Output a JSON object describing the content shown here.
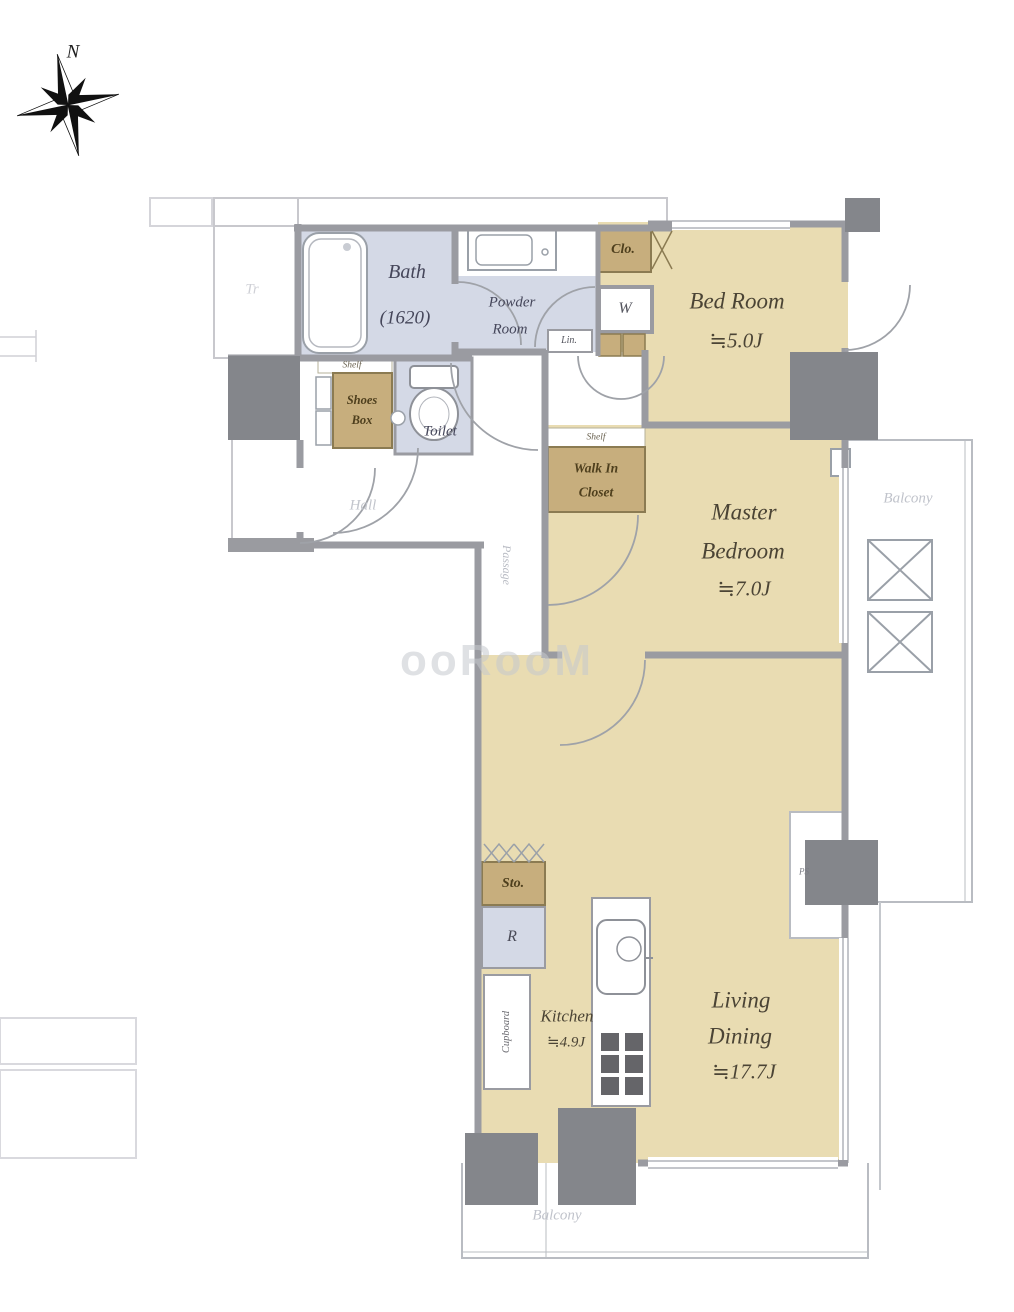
{
  "palette": {
    "room_tan": "#e9dcb2",
    "wet_blue": "#d4d9e6",
    "storage_brown": "#c7ae7d",
    "wall_gray": "#9a9ba1",
    "column_gray": "#84868b",
    "label_brown": "#4b4435",
    "faint_gray": "#c0c3cb"
  },
  "compass": {
    "label": "N"
  },
  "watermark": {
    "text": "ooRooM"
  },
  "rooms": {
    "trunk": {
      "label": "Tr"
    },
    "bath": {
      "name": "Bath",
      "size": "(1620)"
    },
    "powder": {
      "line1": "Powder",
      "line2": "Room"
    },
    "toilet": {
      "name": "Toilet"
    },
    "hall": {
      "name": "Hall"
    },
    "passage": {
      "name": "Passage"
    },
    "bedroom": {
      "line1": "Bed Room",
      "line2": "≒5.0J"
    },
    "master": {
      "line1": "Master",
      "line2": "Bedroom",
      "line3": "≒7.0J"
    },
    "kitchen": {
      "line1": "Kitchen",
      "line2": "≒4.9J"
    },
    "living": {
      "line1": "Living",
      "line2": "Dining",
      "line3": "≒17.7J"
    },
    "balcony_right": {
      "label": "Balcony"
    },
    "balcony_bottom": {
      "label": "Balcony"
    }
  },
  "storage": {
    "closet": "Clo.",
    "washer": "W",
    "linen": "Lin.",
    "shoes_shelf": "Shelf",
    "shoes_line1": "Shoes",
    "shoes_line2": "Box",
    "wic_shelf": "Shelf",
    "wic_line1": "Walk In",
    "wic_line2": "Closet",
    "storage": "Sto.",
    "fridge": "R",
    "cupboard": "Cupboard",
    "pipe_space": "PS"
  }
}
